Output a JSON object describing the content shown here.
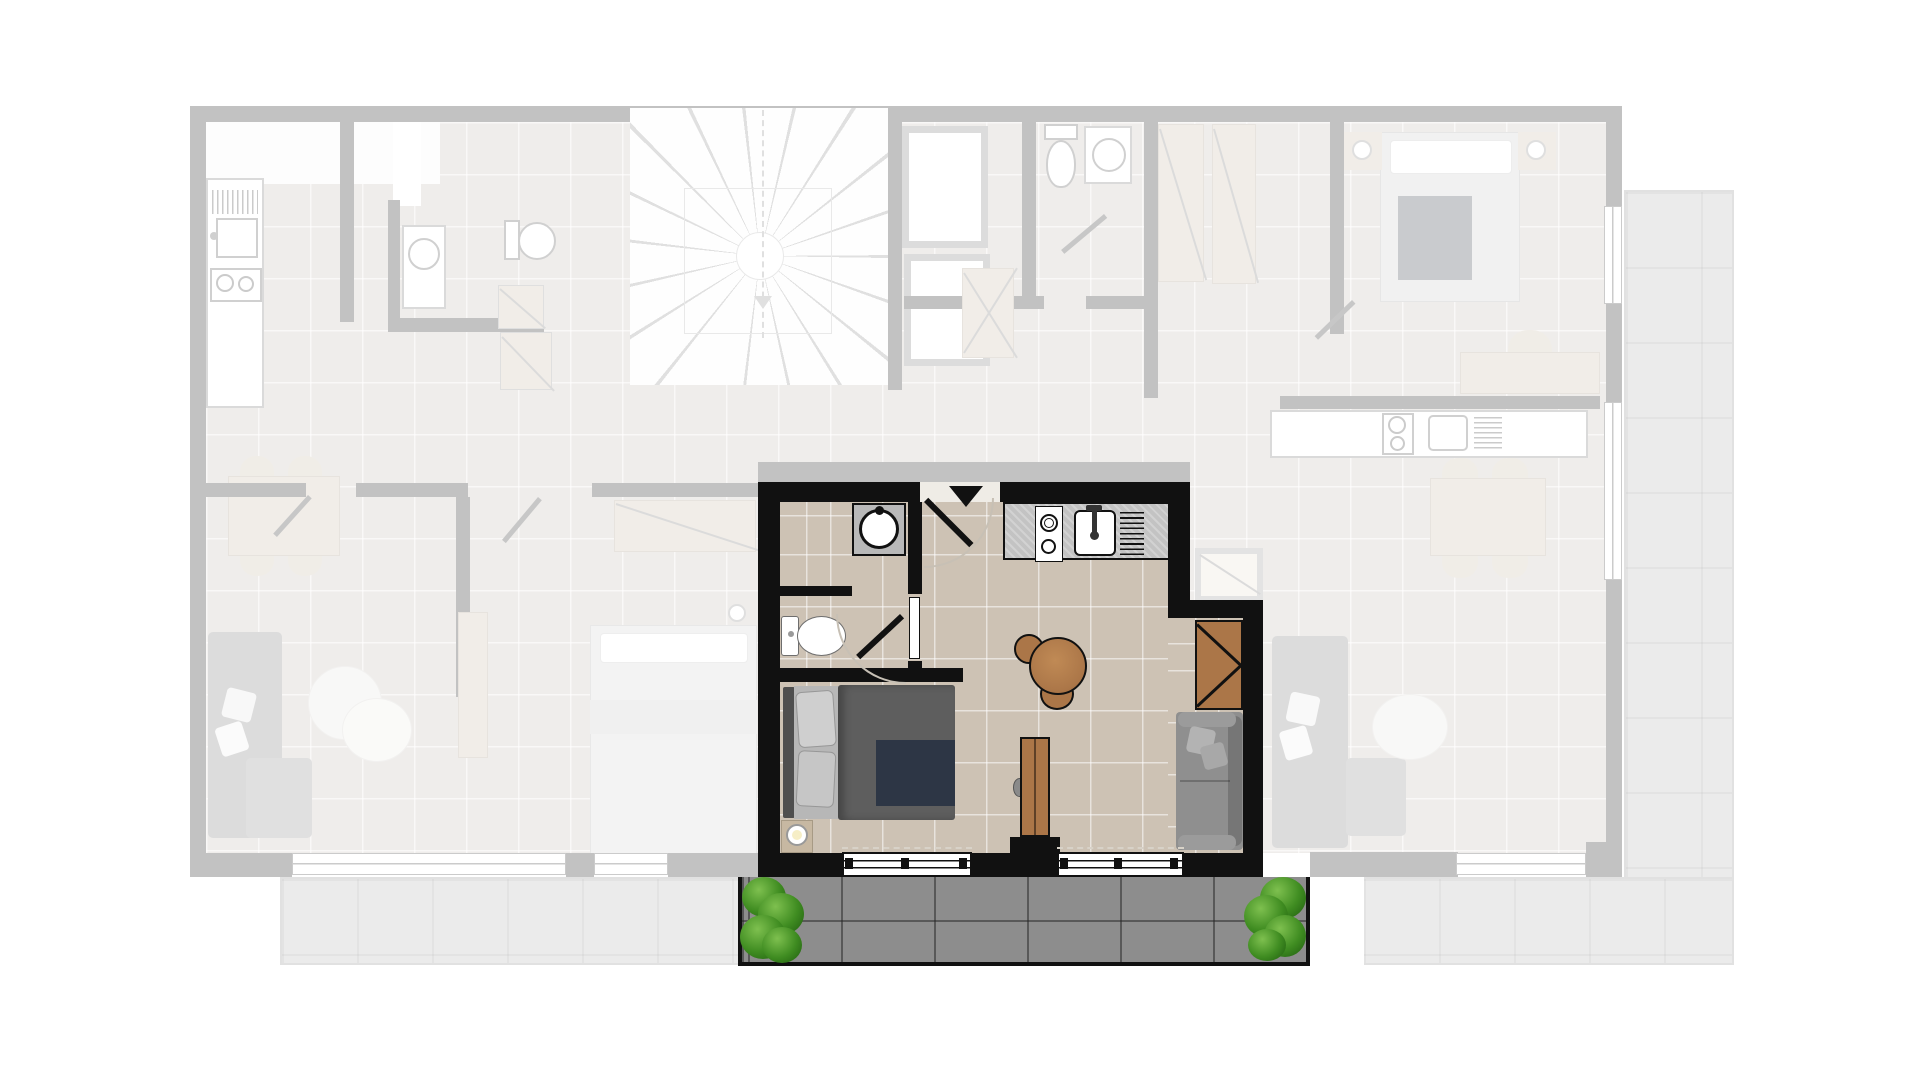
{
  "plan": {
    "kind": "residential building floor plan, one studio unit highlighted in full color",
    "highlighted_unit": {
      "type": "studio apartment",
      "rooms": [
        "bathroom",
        "entry",
        "kitchenette",
        "living-sleeping room",
        "balcony"
      ],
      "fixtures_and_furniture": [
        "wash basin on cabinet",
        "toilet",
        "bathroom door",
        "entry door with swing arc",
        "kitchen counter",
        "two-burner hob",
        "kitchen sink with faucet",
        "dish drainer",
        "round dining table",
        "two dining chairs",
        "wardrobe",
        "two-seat sofa with cushions",
        "double bed with pillows and blanket",
        "bedside table with lamp",
        "tv sideboard",
        "two windows",
        "balcony with two planters"
      ],
      "window_count": 2,
      "planter_count": 2
    },
    "faded_context": {
      "description": "surrounding apartments and common core shown ghosted",
      "features": [
        "left apartment with kitchen, bathroom, dining table, sofa and bedroom",
        "central winder staircase with dashed walk line",
        "two elevator shafts",
        "corridor",
        "middle apartment bedroom with wardrobe and bed",
        "shared bathroom with toilet and basin",
        "right apartment with bedroom, desk, kitchen, dining table and sofa",
        "left balcony",
        "right wrap-around balcony",
        "service shaft"
      ]
    }
  },
  "colors": {
    "hl_wall": "#111111",
    "floor": "#cdc2b4",
    "floor_joint": "rgba(255,255,255,0.55)",
    "wood": "#ab7648",
    "wood_light": "#dcc5a7",
    "counter_gray": "#c3c3c3",
    "balcony_tile": "#8d8d8d",
    "balcony_joint": "rgba(35,35,35,0.5)",
    "plant_light": "#7ec04f",
    "plant_mid": "#3f8c21",
    "plant_dark": "#1d5a0e",
    "sofa_gray": "#8f8f8f",
    "bed_duvet": "#5e5e5e",
    "bed_blanket": "#2d3645",
    "bg_wall": "#3a3a3a",
    "bg_floor": "#cfc5b8"
  }
}
